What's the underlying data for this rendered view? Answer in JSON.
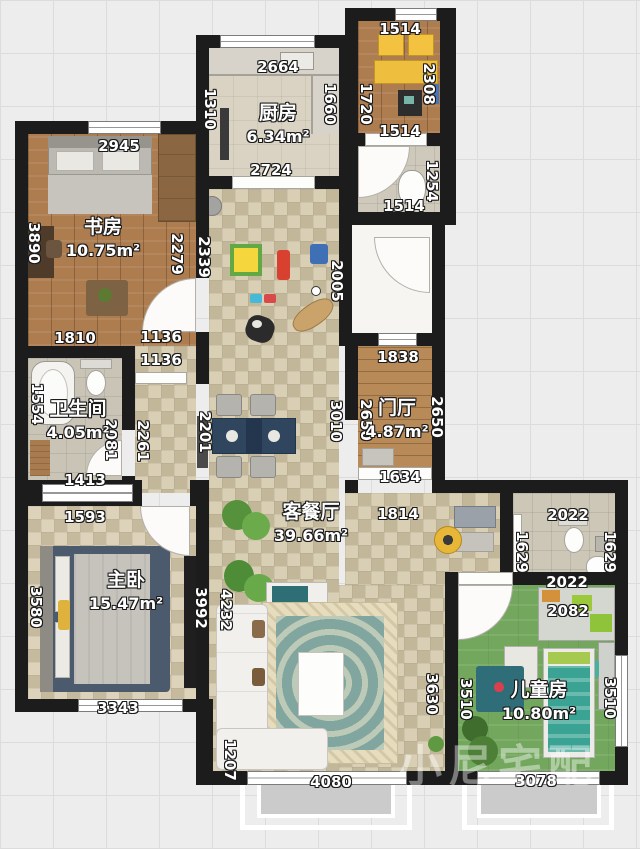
{
  "watermark": "小尼宅配",
  "rooms": [
    {
      "id": "kitchen",
      "name": "厨房",
      "area": "6.34m²",
      "x": 278,
      "y": 122
    },
    {
      "id": "study",
      "name": "书房",
      "area": "10.75m²",
      "x": 103,
      "y": 236
    },
    {
      "id": "bathroom",
      "name": "卫生间",
      "area": "4.05m²",
      "x": 78,
      "y": 418
    },
    {
      "id": "foyer",
      "name": "门厅",
      "area": "4.87m²",
      "x": 397,
      "y": 417
    },
    {
      "id": "living-dining",
      "name": "客餐厅",
      "area": "39.66m²",
      "x": 311,
      "y": 521
    },
    {
      "id": "master-bedroom",
      "name": "主卧",
      "area": "15.47m²",
      "x": 126,
      "y": 589
    },
    {
      "id": "kids-room",
      "name": "儿童房",
      "area": "10.80m²",
      "x": 539,
      "y": 699
    }
  ],
  "dimensions": [
    {
      "t": "2945",
      "x": 119,
      "y": 146,
      "r": 0
    },
    {
      "t": "2664",
      "x": 278,
      "y": 67,
      "r": 0
    },
    {
      "t": "1514",
      "x": 400,
      "y": 29,
      "r": 0
    },
    {
      "t": "1310",
      "x": 210,
      "y": 109,
      "r": 90
    },
    {
      "t": "1660",
      "x": 330,
      "y": 104,
      "r": 90
    },
    {
      "t": "1720",
      "x": 366,
      "y": 104,
      "r": 90
    },
    {
      "t": "2308",
      "x": 429,
      "y": 84,
      "r": 90
    },
    {
      "t": "2724",
      "x": 271,
      "y": 170,
      "r": 0
    },
    {
      "t": "1514",
      "x": 400,
      "y": 131,
      "r": 0
    },
    {
      "t": "1254",
      "x": 432,
      "y": 181,
      "r": 90
    },
    {
      "t": "1514",
      "x": 404,
      "y": 206,
      "r": 0
    },
    {
      "t": "3890",
      "x": 34,
      "y": 243,
      "r": 90
    },
    {
      "t": "2279",
      "x": 177,
      "y": 254,
      "r": 90
    },
    {
      "t": "2339",
      "x": 204,
      "y": 257,
      "r": 90
    },
    {
      "t": "2005",
      "x": 337,
      "y": 281,
      "r": 90
    },
    {
      "t": "1810",
      "x": 75,
      "y": 338,
      "r": 0
    },
    {
      "t": "1136",
      "x": 161,
      "y": 337,
      "r": 0
    },
    {
      "t": "1136",
      "x": 161,
      "y": 360,
      "r": 0
    },
    {
      "t": "1554",
      "x": 37,
      "y": 404,
      "r": 90
    },
    {
      "t": "2081",
      "x": 111,
      "y": 440,
      "r": 90
    },
    {
      "t": "2261",
      "x": 143,
      "y": 441,
      "r": 90
    },
    {
      "t": "2201",
      "x": 205,
      "y": 432,
      "r": 90
    },
    {
      "t": "1838",
      "x": 398,
      "y": 357,
      "r": 0
    },
    {
      "t": "2650",
      "x": 366,
      "y": 420,
      "r": 90
    },
    {
      "t": "2650",
      "x": 437,
      "y": 417,
      "r": 90
    },
    {
      "t": "3010",
      "x": 336,
      "y": 421,
      "r": 90
    },
    {
      "t": "1634",
      "x": 400,
      "y": 477,
      "r": 0
    },
    {
      "t": "1413",
      "x": 85,
      "y": 480,
      "r": 0
    },
    {
      "t": "1593",
      "x": 85,
      "y": 517,
      "r": 0
    },
    {
      "t": "1814",
      "x": 398,
      "y": 514,
      "r": 0
    },
    {
      "t": "2022",
      "x": 568,
      "y": 515,
      "r": 0
    },
    {
      "t": "1629",
      "x": 522,
      "y": 552,
      "r": 90
    },
    {
      "t": "1629",
      "x": 610,
      "y": 552,
      "r": 90
    },
    {
      "t": "2022",
      "x": 567,
      "y": 582,
      "r": 0
    },
    {
      "t": "2082",
      "x": 568,
      "y": 611,
      "r": 0
    },
    {
      "t": "3580",
      "x": 36,
      "y": 607,
      "r": 90
    },
    {
      "t": "3992",
      "x": 201,
      "y": 608,
      "r": 90
    },
    {
      "t": "4232",
      "x": 226,
      "y": 610,
      "r": 90
    },
    {
      "t": "3630",
      "x": 432,
      "y": 694,
      "r": 90
    },
    {
      "t": "3510",
      "x": 466,
      "y": 699,
      "r": 90
    },
    {
      "t": "3510",
      "x": 610,
      "y": 698,
      "r": 90
    },
    {
      "t": "3343",
      "x": 118,
      "y": 708,
      "r": 0
    },
    {
      "t": "1207",
      "x": 230,
      "y": 760,
      "r": 90
    },
    {
      "t": "4080",
      "x": 331,
      "y": 782,
      "r": 0
    },
    {
      "t": "3078",
      "x": 536,
      "y": 781,
      "r": 0
    }
  ]
}
